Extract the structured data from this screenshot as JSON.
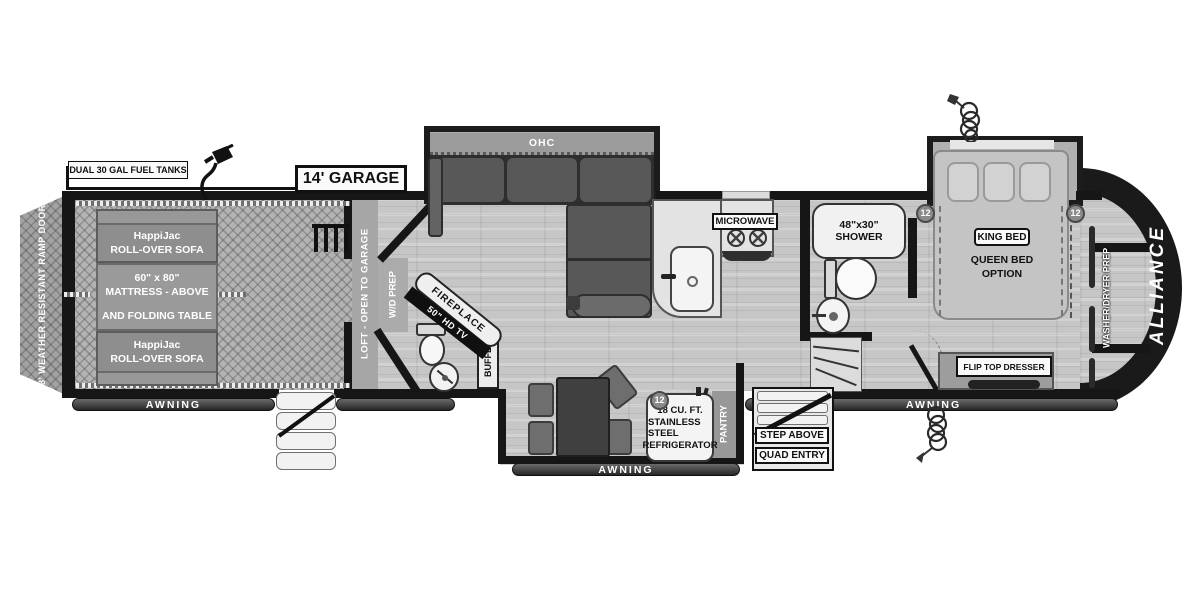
{
  "plan": {
    "brand": "ALLIANCE",
    "garage_dimension": "14' GARAGE",
    "fuel_label": "DUAL 30 GAL FUEL TANKS",
    "ramp_door": "8' WEATHER RESISTANT RAMP DOOR"
  },
  "garage": {
    "sofa_front": {
      "line1": "HappiJac",
      "line2": "ROLL-OVER SOFA"
    },
    "bunk": {
      "line1": "60\" x 80\"",
      "line2": "MATTRESS - ABOVE",
      "line3": "AND FOLDING TABLE"
    },
    "sofa_rear": {
      "line1": "HappiJac",
      "line2": "ROLL-OVER SOFA"
    },
    "loft": "LOFT - OPEN TO GARAGE"
  },
  "living": {
    "ohc": "OHC",
    "wd_prep": "W/D PREP",
    "fireplace": "FIREPLACE",
    "tv": "50\" HD TV",
    "buffet": "BUFFET"
  },
  "kitchen": {
    "microwave": "MICROWAVE",
    "pantry": "PANTRY",
    "refrigerator": {
      "line1": "18 CU. FT.",
      "line2": "STAINLESS STEEL",
      "line3": "REFRIGERATOR"
    }
  },
  "bathroom": {
    "shower_line1": "48\"x30\"",
    "shower_line2": "SHOWER"
  },
  "bedroom": {
    "king_bed": "KING BED",
    "queen_line1": "QUEEN BED",
    "queen_line2": "OPTION",
    "dresser": "FLIP TOP DRESSER",
    "washer_dryer": "WASHER/DRYER PREP"
  },
  "entry": {
    "step_above": "STEP ABOVE",
    "quad_entry": "QUAD ENTRY"
  },
  "awning": {
    "left": "AWNING",
    "center": "AWNING",
    "right": "AWNING"
  },
  "badges": {
    "b1": "12",
    "b2": "12",
    "b3": "12"
  },
  "colors": {
    "wall": "#161616",
    "floor_gray": "#c6c6c6",
    "cap_black": "#1a1a1a"
  }
}
